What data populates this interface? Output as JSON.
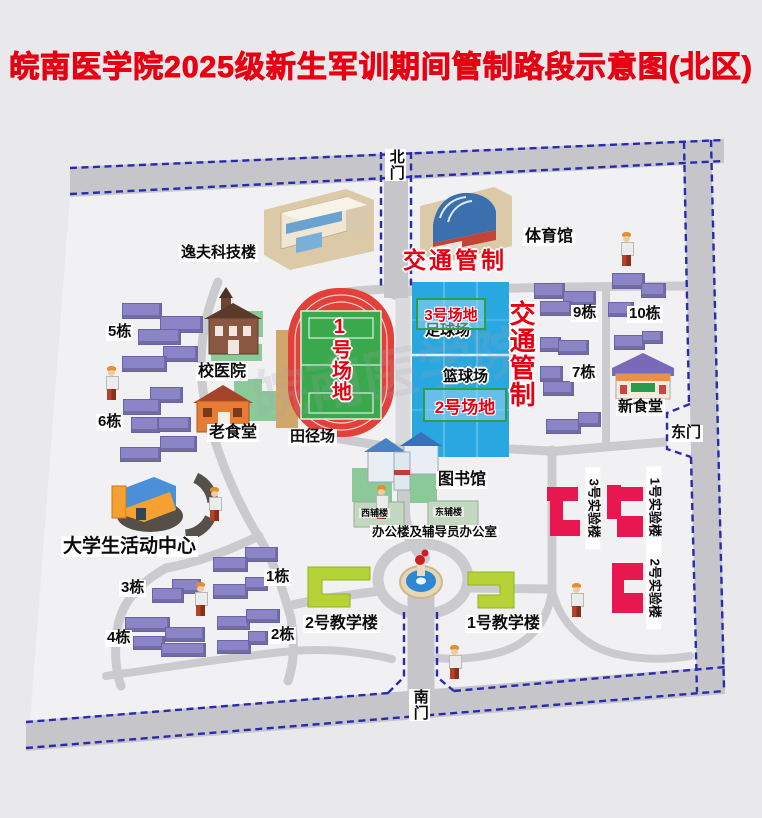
{
  "title": "皖南医学院2025级新生军训期间管制路段示意图(北区)",
  "watermark": "皖南医学院",
  "gates": {
    "north": "北门",
    "south": "南门",
    "east": "东门"
  },
  "traffic_control": {
    "horizontal": "交通管制",
    "vertical": "交通管制"
  },
  "fields": {
    "field1": "1号场地",
    "field2": "2号场地",
    "field3": "3号场地",
    "track": "田径场",
    "football": "足球场",
    "basketball": "篮球场"
  },
  "landmarks": {
    "yifu": "逸夫科技楼",
    "gym": "体育馆",
    "hospital": "校医院",
    "old_canteen": "老食堂",
    "new_canteen": "新食堂",
    "library": "图书馆",
    "activity_center": "大学生活动中心",
    "office": "办公楼及辅导员办公室",
    "west_annex": "西辅楼",
    "east_annex": "东辅楼",
    "teach1": "1号教学楼",
    "teach2": "2号教学楼",
    "lab1": "1号实验楼",
    "lab2": "2号实验楼",
    "lab3": "3号实验楼"
  },
  "colors": {
    "accent_red": "#e60012",
    "court_blue": "#29a7e0",
    "pitch_green": "#3aa84c",
    "track_red": "#e2413a",
    "dorm_purple": "#8b84c6",
    "lab_pink": "#e8174f",
    "teach_green": "#b5d337",
    "road_gray": "#c6c6ca",
    "dash_blue": "#2a2aae",
    "lawn_green": "#8cc998"
  },
  "map": {
    "dorm_labels": [
      {
        "text": "5栋",
        "x": 106,
        "y": 324
      },
      {
        "text": "6栋",
        "x": 96,
        "y": 414
      },
      {
        "text": "9栋",
        "x": 571,
        "y": 305
      },
      {
        "text": "10栋",
        "x": 627,
        "y": 306
      },
      {
        "text": "7栋",
        "x": 570,
        "y": 365
      },
      {
        "text": "1栋",
        "x": 264,
        "y": 569
      },
      {
        "text": "2栋",
        "x": 269,
        "y": 627
      },
      {
        "text": "3栋",
        "x": 119,
        "y": 580
      },
      {
        "text": "4栋",
        "x": 105,
        "y": 630
      }
    ],
    "dorm_blocks": [
      [
        122,
        303,
        38,
        14
      ],
      [
        160,
        316,
        41,
        15
      ],
      [
        138,
        329,
        41,
        14
      ],
      [
        163,
        346,
        33,
        14
      ],
      [
        122,
        356,
        43,
        14
      ],
      [
        150,
        387,
        31,
        14
      ],
      [
        123,
        399,
        36,
        14
      ],
      [
        131,
        417,
        27,
        14
      ],
      [
        158,
        417,
        31,
        13
      ],
      [
        160,
        436,
        35,
        14
      ],
      [
        120,
        447,
        39,
        13
      ],
      [
        534,
        283,
        29,
        14
      ],
      [
        563,
        291,
        31,
        13
      ],
      [
        612,
        273,
        31,
        14
      ],
      [
        641,
        283,
        23,
        13
      ],
      [
        540,
        301,
        30,
        13
      ],
      [
        608,
        302,
        24,
        13
      ],
      [
        540,
        337,
        19,
        13
      ],
      [
        558,
        340,
        29,
        13
      ],
      [
        614,
        335,
        29,
        13
      ],
      [
        642,
        331,
        19,
        11
      ],
      [
        540,
        366,
        21,
        14
      ],
      [
        543,
        381,
        29,
        13
      ],
      [
        546,
        419,
        33,
        13
      ],
      [
        578,
        412,
        21,
        13
      ],
      [
        245,
        547,
        31,
        13
      ],
      [
        213,
        557,
        33,
        13
      ],
      [
        172,
        579,
        27,
        13
      ],
      [
        152,
        588,
        30,
        13
      ],
      [
        213,
        584,
        33,
        13
      ],
      [
        245,
        577,
        21,
        12
      ],
      [
        125,
        617,
        43,
        13
      ],
      [
        165,
        627,
        38,
        13
      ],
      [
        217,
        616,
        31,
        12
      ],
      [
        246,
        609,
        32,
        12
      ],
      [
        133,
        636,
        30,
        12
      ],
      [
        161,
        643,
        43,
        12
      ],
      [
        217,
        640,
        32,
        12
      ],
      [
        248,
        631,
        18,
        12
      ]
    ],
    "lawns": [
      [
        235,
        311,
        28,
        26
      ],
      [
        211,
        344,
        51,
        17
      ],
      [
        234,
        379,
        28,
        20
      ],
      [
        240,
        391,
        56,
        30
      ],
      [
        352,
        468,
        40,
        34
      ],
      [
        397,
        471,
        40,
        32
      ]
    ],
    "persons": [
      [
        103,
        366
      ],
      [
        618,
        232
      ],
      [
        373,
        485
      ],
      [
        206,
        487
      ],
      [
        192,
        582
      ],
      [
        446,
        645
      ],
      [
        568,
        583
      ]
    ]
  }
}
